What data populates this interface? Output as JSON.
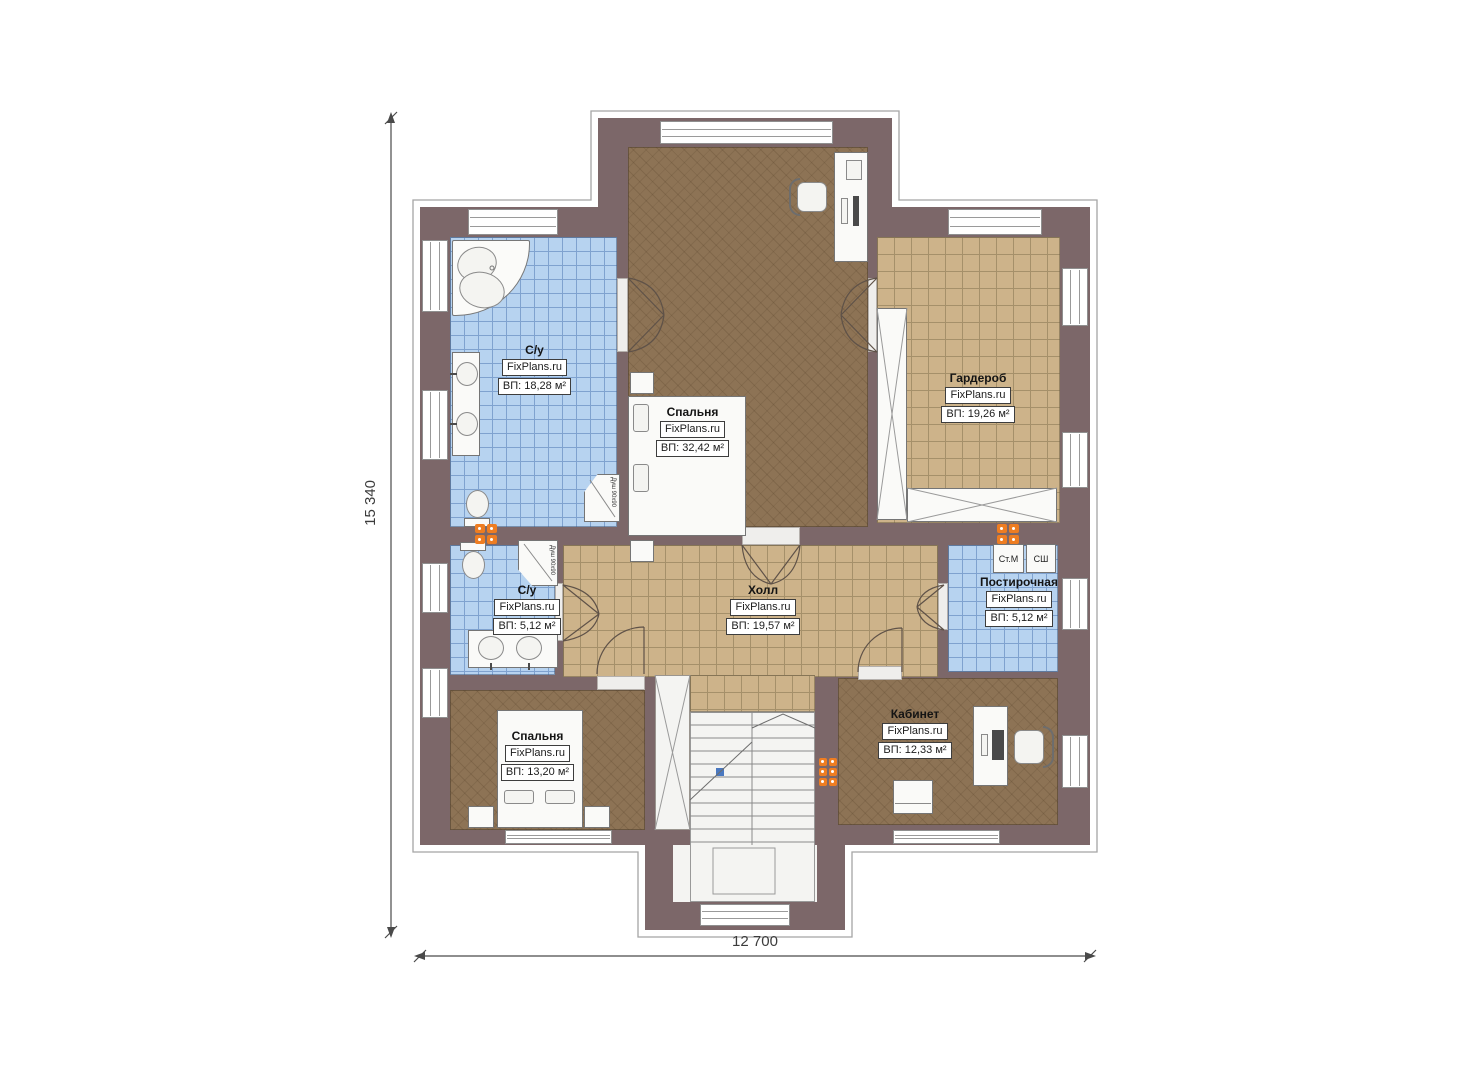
{
  "plan": {
    "dimensions": {
      "width_label": "12 700",
      "height_label": "15 340"
    },
    "rooms": [
      {
        "key": "bathroom-top",
        "name": "С/у",
        "brand": "FixPlans.ru",
        "area": "ВП: 18,28 м²"
      },
      {
        "key": "bedroom-main",
        "name": "Спальня",
        "brand": "FixPlans.ru",
        "area": "ВП: 32,42 м²"
      },
      {
        "key": "wardrobe",
        "name": "Гардероб",
        "brand": "FixPlans.ru",
        "area": "ВП: 19,26 м²"
      },
      {
        "key": "bathroom-middle",
        "name": "С/у",
        "brand": "FixPlans.ru",
        "area": "ВП: 5,12 м²"
      },
      {
        "key": "hall",
        "name": "Холл",
        "brand": "FixPlans.ru",
        "area": "ВП: 19,57 м²"
      },
      {
        "key": "laundry",
        "name": "Постирочная",
        "brand": "FixPlans.ru",
        "area": "ВП: 5,12 м²"
      },
      {
        "key": "bedroom-second",
        "name": "Спальня",
        "brand": "FixPlans.ru",
        "area": "ВП: 13,20 м²"
      },
      {
        "key": "office",
        "name": "Кабинет",
        "brand": "FixPlans.ru",
        "area": "ВП: 12,33 м²"
      }
    ],
    "appliances": {
      "washing_machine": "Ст.М",
      "drying_cabinet": "СШ"
    },
    "annotations": {
      "shower_size": "Душ 90х90"
    },
    "colors": {
      "wall": "#7c6769",
      "floor_wood": "#8d7355",
      "tile_beige": "#cdb38a",
      "tile_blue": "#b7d3f0",
      "radiator": "#ee7d22"
    }
  }
}
